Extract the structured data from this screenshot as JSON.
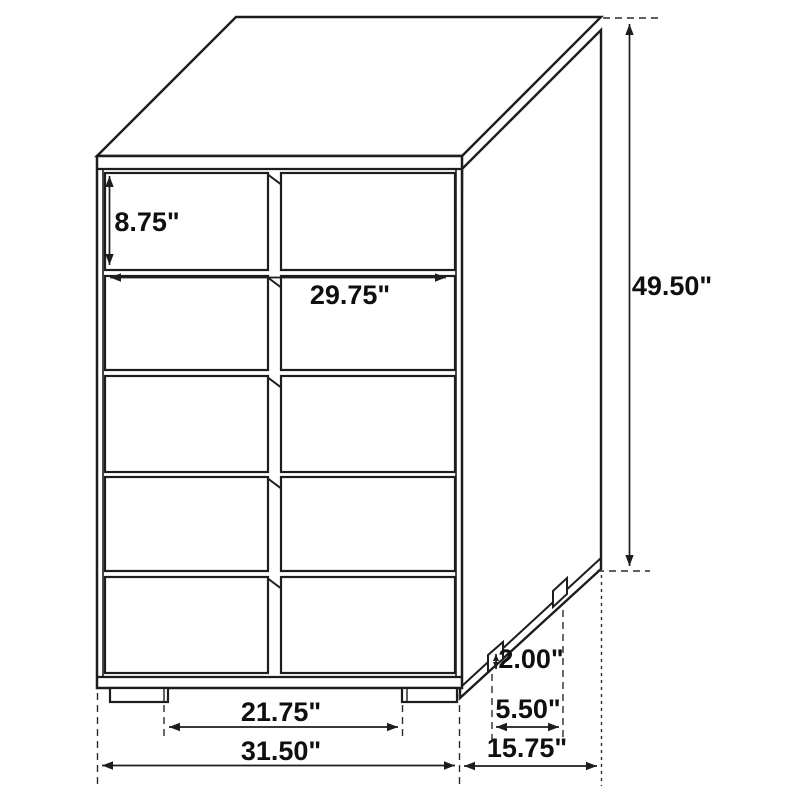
{
  "diagram": {
    "object": "chest-of-drawers",
    "unit": "inches",
    "drawer_rows": 5,
    "drawer_columns": 2,
    "line_color": "#1d1d1d",
    "text_color": "#0f0f0f",
    "dimensions": {
      "top_drawer_height": "8.75\"",
      "drawer_width": "29.75\"",
      "overall_height": "49.50\"",
      "leg_height": "2.00\"",
      "side_leg_spacing": "5.50\"",
      "front_leg_span": "21.75\"",
      "overall_width": "31.50\"",
      "overall_depth": "15.75\""
    }
  }
}
